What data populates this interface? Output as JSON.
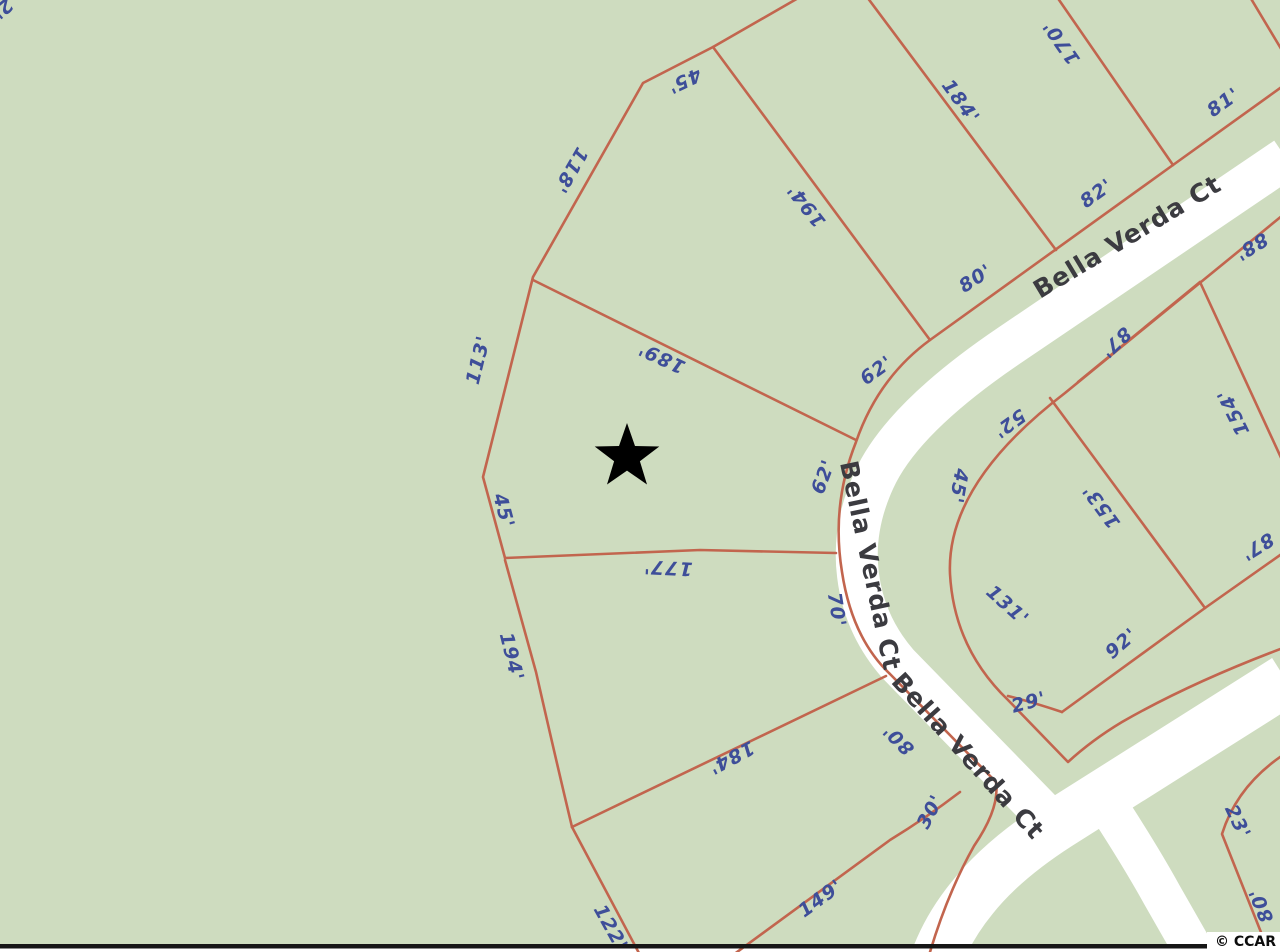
{
  "map": {
    "marker": {
      "shape": "star",
      "x": 627,
      "y": 457
    },
    "street_labels": [
      {
        "text": "Bella Verda Ct",
        "x": 1128,
        "y": 238,
        "rot": -31
      },
      {
        "text": "Bella Verda Ct",
        "x": 869,
        "y": 566,
        "rot": 78
      },
      {
        "text": "Bella Verda Ct",
        "x": 967,
        "y": 757,
        "rot": 48
      }
    ],
    "dimension_labels": [
      {
        "text": "45'",
        "x": 684,
        "y": 80,
        "rot": 155
      },
      {
        "text": "118'",
        "x": 570,
        "y": 170,
        "rot": 120
      },
      {
        "text": "194'",
        "x": 807,
        "y": 205,
        "rot": 232
      },
      {
        "text": "184'",
        "x": 960,
        "y": 102,
        "rot": 54
      },
      {
        "text": "170'",
        "x": 1062,
        "y": 42,
        "rot": 235
      },
      {
        "text": "81'",
        "x": 1224,
        "y": 103,
        "rot": -36
      },
      {
        "text": "82'",
        "x": 1097,
        "y": 194,
        "rot": -36
      },
      {
        "text": "80'",
        "x": 976,
        "y": 279,
        "rot": -33
      },
      {
        "text": "62'",
        "x": 877,
        "y": 371,
        "rot": -36
      },
      {
        "text": "88'",
        "x": 1251,
        "y": 246,
        "rot": 148
      },
      {
        "text": "113'",
        "x": 479,
        "y": 360,
        "rot": -76
      },
      {
        "text": "189'",
        "x": 662,
        "y": 357,
        "rot": 205
      },
      {
        "text": "62'",
        "x": 824,
        "y": 477,
        "rot": -69
      },
      {
        "text": "45'",
        "x": 503,
        "y": 511,
        "rot": 75
      },
      {
        "text": "177'",
        "x": 668,
        "y": 567,
        "rot": 183
      },
      {
        "text": "70'",
        "x": 836,
        "y": 610,
        "rot": 81
      },
      {
        "text": "194'",
        "x": 511,
        "y": 657,
        "rot": 76
      },
      {
        "text": "184'",
        "x": 731,
        "y": 757,
        "rot": 152
      },
      {
        "text": "122'",
        "x": 610,
        "y": 928,
        "rot": 61
      },
      {
        "text": "149'",
        "x": 821,
        "y": 899,
        "rot": -36
      },
      {
        "text": "80'",
        "x": 899,
        "y": 739,
        "rot": 225
      },
      {
        "text": "30'",
        "x": 931,
        "y": 812,
        "rot": -62
      },
      {
        "text": "52'",
        "x": 1009,
        "y": 423,
        "rot": 144
      },
      {
        "text": "45'",
        "x": 958,
        "y": 486,
        "rot": 100
      },
      {
        "text": "131'",
        "x": 1007,
        "y": 606,
        "rot": 42
      },
      {
        "text": "153'",
        "x": 1102,
        "y": 506,
        "rot": 234
      },
      {
        "text": "87'",
        "x": 1115,
        "y": 342,
        "rot": 136
      },
      {
        "text": "154'",
        "x": 1234,
        "y": 412,
        "rot": 244
      },
      {
        "text": "87'",
        "x": 1257,
        "y": 546,
        "rot": 148
      },
      {
        "text": "92'",
        "x": 1122,
        "y": 644,
        "rot": -41
      },
      {
        "text": "29'",
        "x": 1029,
        "y": 703,
        "rot": -15
      },
      {
        "text": "23'",
        "x": 1237,
        "y": 822,
        "rot": 65
      },
      {
        "text": "80'",
        "x": 1262,
        "y": 905,
        "rot": -112
      },
      {
        "text": "2'",
        "x": 2,
        "y": 8,
        "rot": 140
      }
    ]
  },
  "watermark": {
    "text": "© CCAR"
  },
  "colors": {
    "background_green": "#cedcbf",
    "road_white": "#ffffff",
    "lot_line_red": "#c2654e",
    "dimension_text_blue": "#3e4e99",
    "street_text_gray": "#3b3b40",
    "marker_black": "#000000",
    "border_black": "#161616"
  }
}
